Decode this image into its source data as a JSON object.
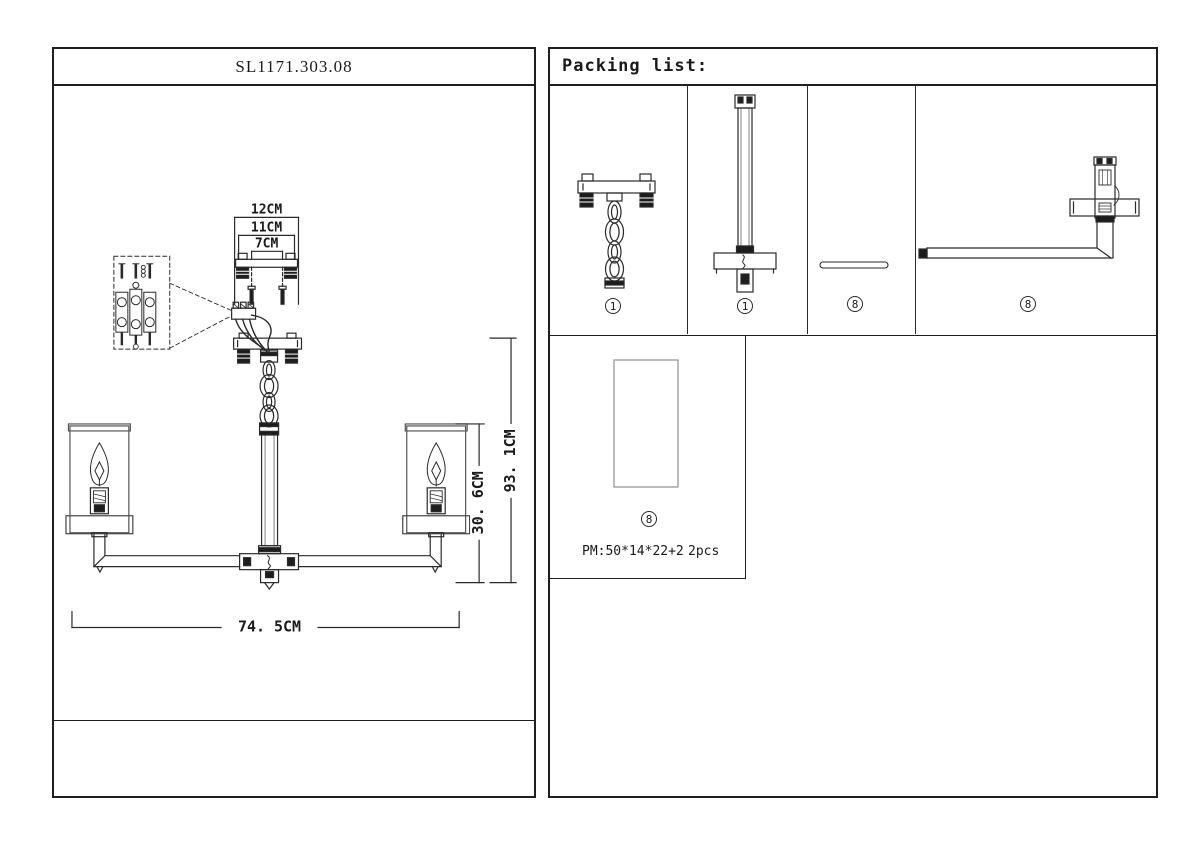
{
  "window": {
    "background": "#ffffff"
  },
  "colors": {
    "line": "#2a2a2a",
    "border": "#1f1f1f",
    "glass_outline": "#999999"
  },
  "left_panel": {
    "title": "SL1171.303.08",
    "dimensions": {
      "bracket_width": "12CM",
      "plate_width": "11CM",
      "hole_spacing": "7CM",
      "fixture_width": "74. 5CM",
      "shade_section_height": "30. 6CM",
      "overall_height": "93. 1CM"
    }
  },
  "packing_list": {
    "title": "Packing list:",
    "items": [
      {
        "name": "ceiling-bracket-with-chain",
        "qty": "1"
      },
      {
        "name": "stem-rod-with-canopy",
        "qty": "1"
      },
      {
        "name": "flat-connector-strip",
        "qty": "8"
      },
      {
        "name": "arm-with-lamp-socket",
        "qty": "8"
      },
      {
        "name": "glass-shade",
        "qty": "8",
        "box_note": "PM:50*14*22+2",
        "box_pieces": "2pcs"
      }
    ]
  }
}
